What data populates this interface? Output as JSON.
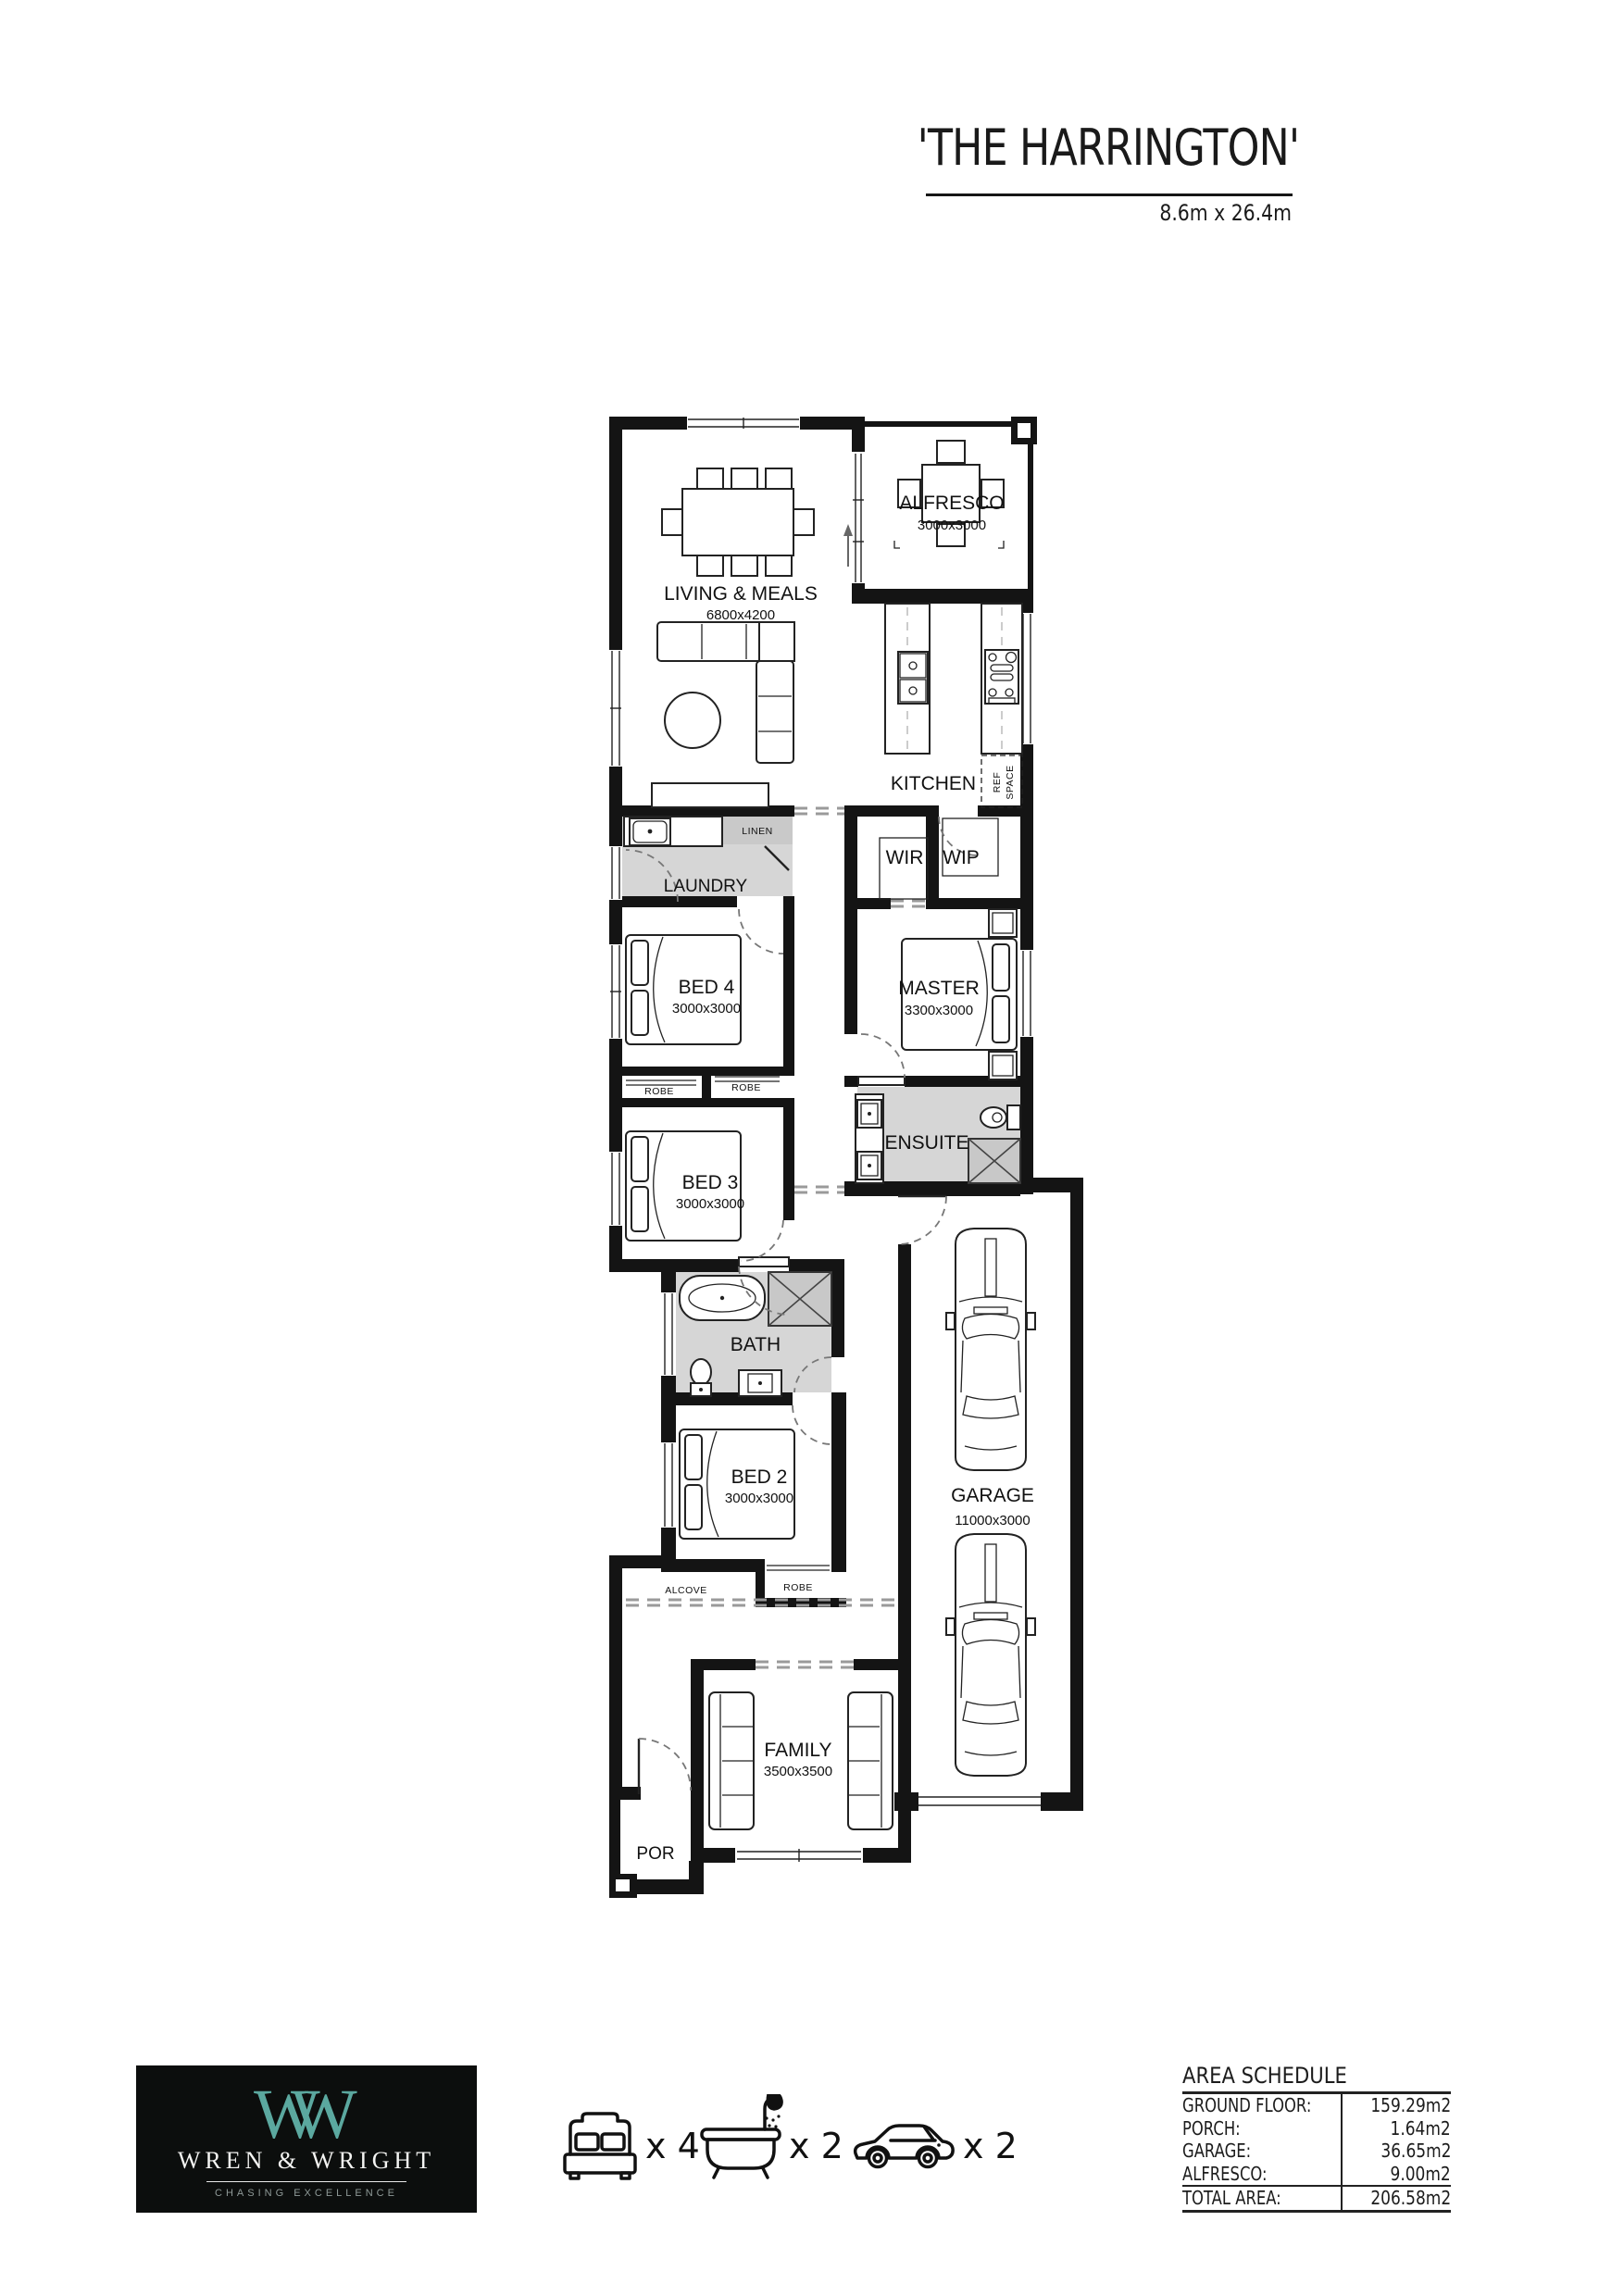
{
  "header": {
    "title": "'THE HARRINGTON'",
    "subtitle": "8.6m x 26.4m"
  },
  "plan": {
    "rooms": {
      "living": {
        "name": "LIVING & MEALS",
        "size": "6800x4200"
      },
      "alfresco": {
        "name": "ALFRESCO",
        "size": "3000x3000"
      },
      "kitchen": {
        "name": "KITCHEN"
      },
      "ref_space": {
        "line1": "REF",
        "line2": "SPACE"
      },
      "linen": {
        "name": "LINEN"
      },
      "laundry": {
        "name": "LAUNDRY"
      },
      "wir": {
        "name": "WIR"
      },
      "wip": {
        "name": "WIP"
      },
      "bed4": {
        "name": "BED 4",
        "size": "3000x3000"
      },
      "master": {
        "name": "MASTER",
        "size": "3300x3000"
      },
      "robe_bed4": {
        "name": "ROBE"
      },
      "robe_bed3": {
        "name": "ROBE"
      },
      "bed3": {
        "name": "BED 3",
        "size": "3000x3000"
      },
      "ensuite": {
        "name": "ENSUITE"
      },
      "bath": {
        "name": "BATH"
      },
      "bed2": {
        "name": "BED 2",
        "size": "3000x3000"
      },
      "alcove": {
        "name": "ALCOVE"
      },
      "robe_bed2": {
        "name": "ROBE"
      },
      "garage": {
        "name": "GARAGE",
        "size": "11000x3000"
      },
      "family": {
        "name": "FAMILY",
        "size": "3500x3500"
      },
      "porch": {
        "name": "POR"
      }
    }
  },
  "legend": {
    "beds": "x 4",
    "baths": "x 2",
    "cars": "x 2"
  },
  "logo": {
    "monogram": "W",
    "brand": "WREN & WRIGHT",
    "tagline": "CHASING EXCELLENCE",
    "accent_color": "#5ba89f"
  },
  "area_schedule": {
    "title": "AREA SCHEDULE",
    "rows": [
      {
        "label": "GROUND FLOOR:",
        "value": "159.29m2"
      },
      {
        "label": "PORCH:",
        "value": "1.64m2"
      },
      {
        "label": "GARAGE:",
        "value": "36.65m2"
      },
      {
        "label": "ALFRESCO:",
        "value": "9.00m2"
      }
    ],
    "total": {
      "label": "TOTAL AREA:",
      "value": "206.58m2"
    }
  },
  "colors": {
    "wall": "#141414",
    "wet_area": "#d6d6d6"
  }
}
